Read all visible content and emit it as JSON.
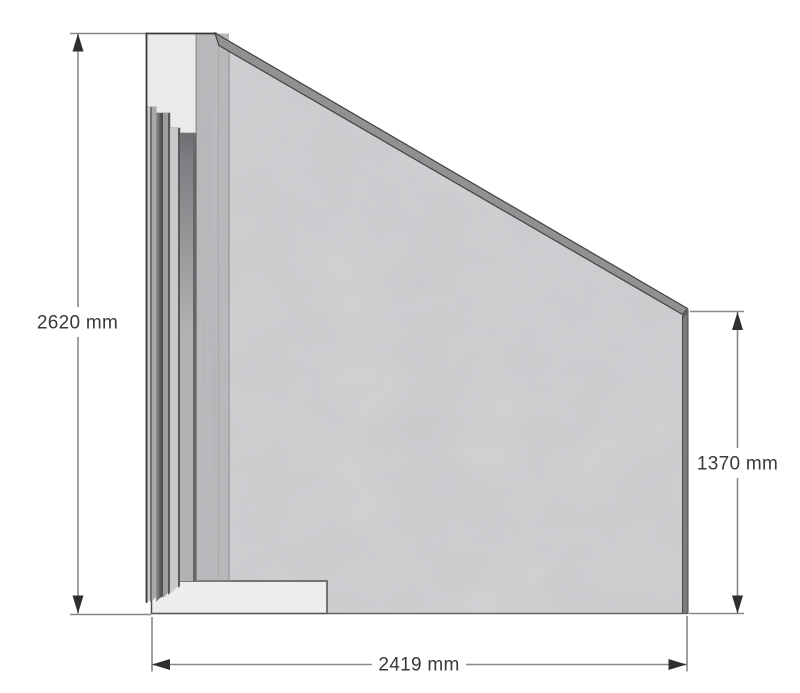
{
  "units": "mm",
  "dimensions": {
    "left_height": {
      "value": 2620,
      "label": "2620 mm"
    },
    "right_height": {
      "value": 1370,
      "label": "1370 mm"
    },
    "bottom_width": {
      "value": 2419,
      "label": "2419 mm"
    }
  },
  "colors": {
    "background": "#ffffff",
    "panel_face": "#d4d5d7",
    "top_edge_band": "#909193",
    "right_edge_band": "#7b7c7e",
    "corner_cap": "#5f6062",
    "post_face": "#bfc0c2",
    "post_cap": "#e9eaec",
    "foot": "#ededef",
    "outline": "#3a3a3c",
    "dimension_line": "#88888b",
    "dimension_text": "#39393b",
    "arrowhead": "#2f2f31"
  },
  "strip_colors": [
    "#cacacc",
    "#707072",
    "#a9a9ab",
    "#7a7a7c",
    "#505052",
    "#9e9ea0",
    "#58585a",
    "#c9c9cb",
    "#5a5a5c",
    "#b2b2b4",
    "#666668"
  ]
}
